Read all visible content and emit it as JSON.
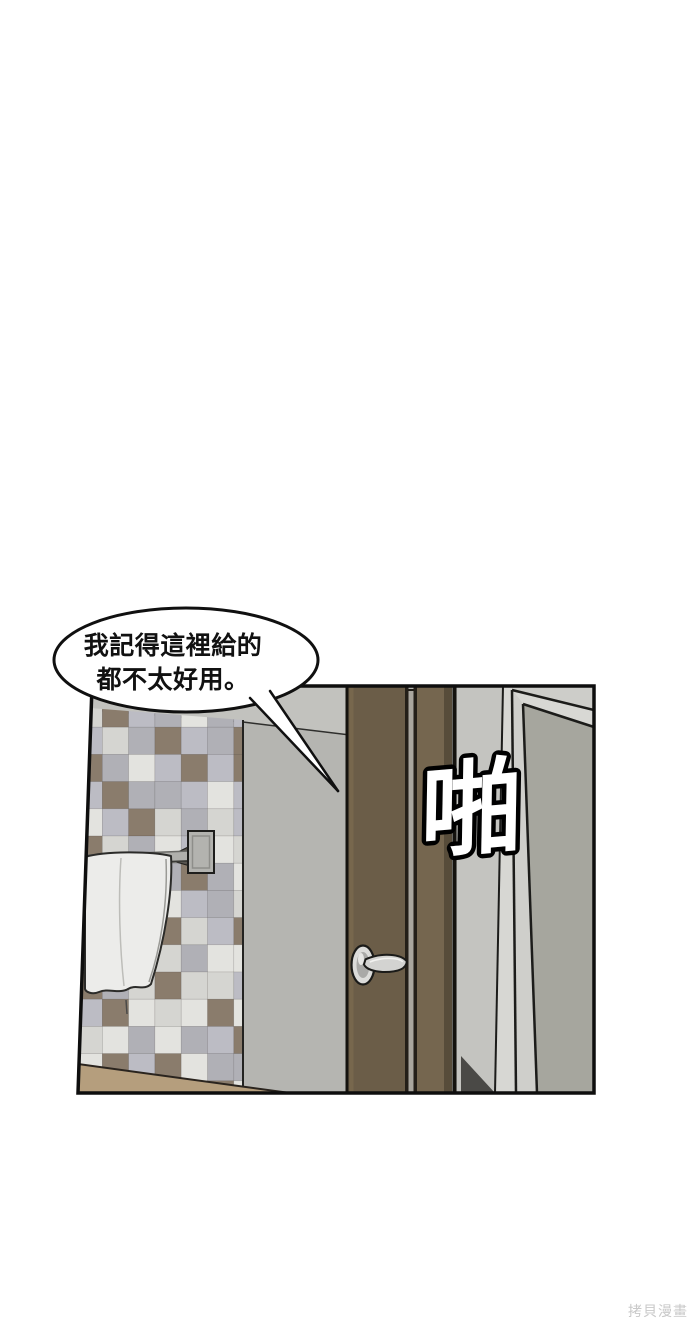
{
  "page": {
    "background": "#ffffff"
  },
  "speech_bubble": {
    "lines": [
      "我記得這裡給的",
      "都不太好用。"
    ],
    "fill": "#ffffff",
    "stroke": "#101010",
    "text_color": "#111111"
  },
  "sfx": {
    "text": "啪",
    "fill": "#ffffff",
    "stroke": "#000000"
  },
  "watermark": {
    "text": "拷貝漫畫",
    "color": "#c9c9c9"
  },
  "palette": {
    "panel_border": "#0e0e0e",
    "wall": "#b5b5b1",
    "wall_upper": "#c2c2be",
    "door": "#6b5d48",
    "door_highlight": "#79694f",
    "door_frame": "#75664f",
    "door_edge_dark": "#574c3a",
    "door_gap_light": "#aaa69e",
    "floor": "#b59e7d",
    "right_wall": "#c4c4c0",
    "frame_light": "#d7d7d3",
    "frame_face": "#cfcfcb",
    "frame_top": "#d8d8d4",
    "above_frame": "#cdcdc9",
    "inner_panel": "#a6a69e",
    "shadow_wedge": "#4a4946",
    "towel": "#ececea",
    "metal": "#dcdcda",
    "bar": "#b0b0ac",
    "tile_colors": [
      "#e3e3df",
      "#bcbcc4",
      "#8a7c6c",
      "#d5d5d1",
      "#b0b0b6"
    ]
  }
}
